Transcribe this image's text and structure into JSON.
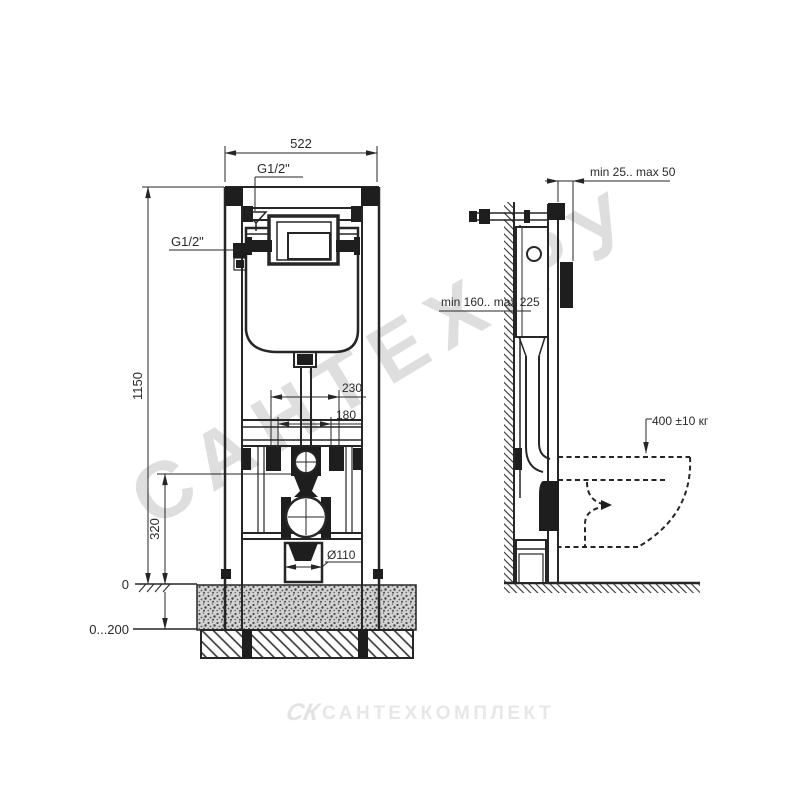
{
  "front_view": {
    "width_top": "522",
    "inlet_top": "G1/2\"",
    "inlet_side": "G1/2\"",
    "height": "1150",
    "valve_height": "320",
    "fixing_width_outer": "230",
    "fixing_width_inner": "180",
    "floor_level": "0",
    "floor_range": "0...200",
    "drain_diameter": "Ø110"
  },
  "side_view": {
    "wall_gap": "min 25.. max 50",
    "depth_range": "min 160.. max 225",
    "load_capacity": "400 ±10 кг"
  },
  "watermarks": {
    "diagonal": "САНТЕХ.РУ",
    "logo": "СК",
    "company": "САНТЕХКОМПЛЕКТ"
  },
  "colors": {
    "line": "#262626",
    "solid_fill": "#1e1e1e",
    "watermark": "#bdbdbd",
    "background": "#ffffff"
  }
}
